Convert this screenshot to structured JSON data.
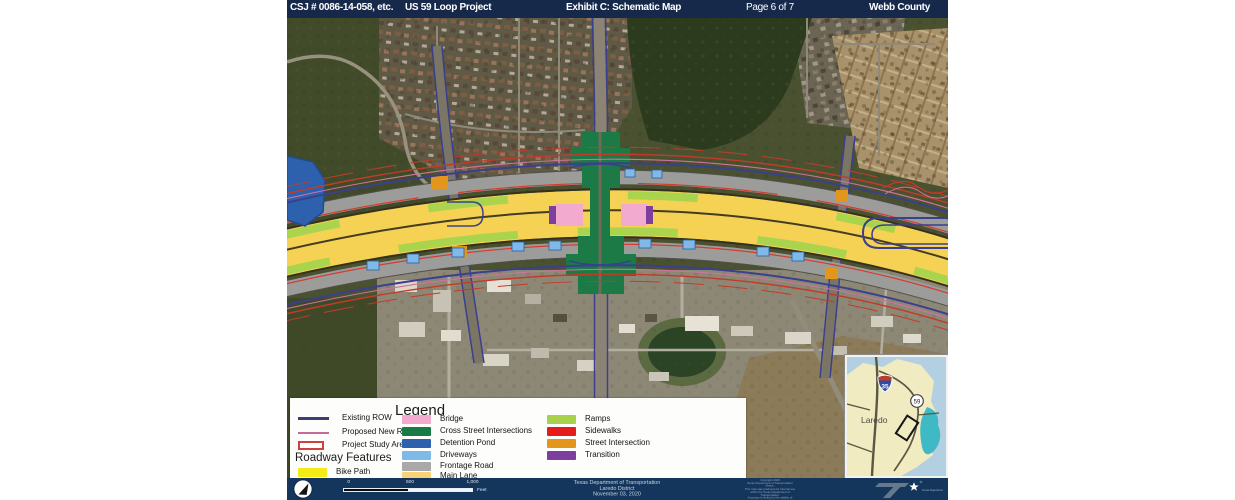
{
  "header": {
    "csj": "CSJ # 0086-14-058, etc.",
    "project": "US 59 Loop Project",
    "exhibit": "Exhibit C: Schematic Map",
    "page": "Page 6 of 7",
    "county": "Webb County"
  },
  "legend": {
    "title": "Legend",
    "left": [
      {
        "label": "Existing ROW",
        "color": "#3d3d78"
      },
      {
        "label": "Proposed New ROW",
        "color": "#c76b93"
      },
      {
        "label": "Project Study Area",
        "color": "#cf4040"
      }
    ],
    "roadway_header": "Roadway Features",
    "bike_path": {
      "label": "Bike Path",
      "color": "#f4ea15"
    },
    "middle": [
      {
        "label": "Bridge",
        "color": "#f2aacf"
      },
      {
        "label": "Cross Street Intersections",
        "color": "#187a45"
      },
      {
        "label": "Detention Pond",
        "color": "#2e61ad"
      },
      {
        "label": "Driveways",
        "color": "#7fb9e8"
      },
      {
        "label": "Frontage Road",
        "color": "#a9a9a9"
      },
      {
        "label": "Main Lane",
        "color": "#f7d477"
      }
    ],
    "right": [
      {
        "label": "Ramps",
        "color": "#a8d14c"
      },
      {
        "label": "Sidewalks",
        "color": "#e51c1c"
      },
      {
        "label": "Street Intersection",
        "color": "#e2971c"
      },
      {
        "label": "Transition",
        "color": "#7c3f9e"
      }
    ]
  },
  "inset": {
    "city": "Laredo",
    "i35": "35",
    "us59": "59"
  },
  "footer": {
    "scale": {
      "ticks": [
        "0",
        "500",
        "1,000"
      ],
      "unit": "Feet"
    },
    "agency_lines": [
      "Texas Department of Transportation",
      "Laredo District",
      "November 03, 2020"
    ],
    "fine_print": [
      "Copyright 2020",
      "Texas Department of Transportation",
      "Notice:",
      "This map was produced for internal use",
      "within the Texas Department of Transportation.",
      "Accuracy is limited to the validity of available",
      "data as of December 31, 2020"
    ],
    "logo": "Texas Department of Transportation"
  },
  "colors": {
    "header_bg": "#16294a",
    "footer_bg": "#15365c",
    "main_lane": "#f6d254",
    "frontage": "#9c9c9a",
    "ramps": "#abd44e",
    "existing_row": "#3a3f8e",
    "study_area": "#c23b2a",
    "proposed_row": "#d0739f"
  }
}
